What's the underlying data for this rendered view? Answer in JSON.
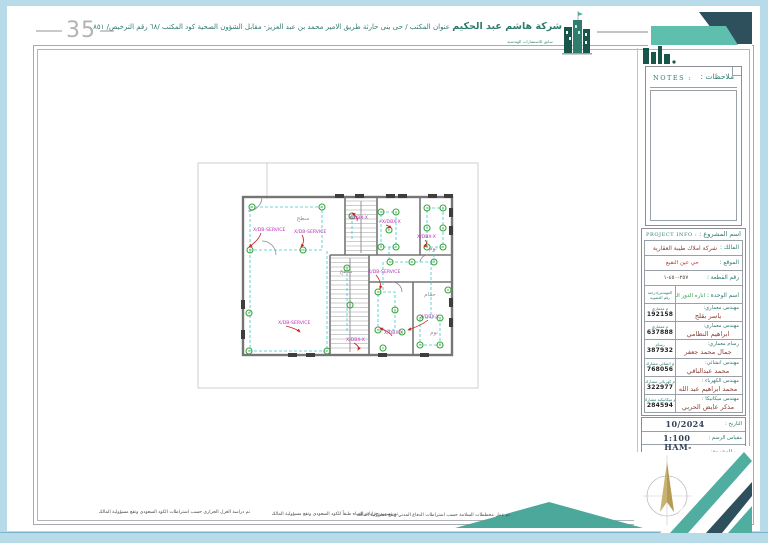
{
  "sheet": {
    "number": "35"
  },
  "header": {
    "company_name": "شركة هاشم عبد الحكيم",
    "company_info": "عنوان المكتب / حى بنى حارثة طريق الامير محمد بن عبد العزيز- مقابل الشؤون الصحية  كود المكتب /٦٨  رقم الترخيص/ ٨٥١",
    "company_sub": "سابق للاستشارات الهندسية"
  },
  "notes": {
    "label_en": "NOTES :",
    "label_ar": "ملاحظات :"
  },
  "project_info": {
    "header_en": "PROJECT INFO :",
    "header_ar": "اسم المشروع :",
    "owner_label": "المالك :",
    "owner_value": "شركة املاك طيبة العقارية",
    "location_label": "الموقع :",
    "location_value": "حي عين النقيع",
    "plot_label": "رقم القطعة :",
    "plot_value": "٢٥٧-٤٥٠-١",
    "unit_label": "اسم الوحدة :",
    "unit_value": "اناره الدور الرابع",
    "col_header_line1": "المهندس/درجته",
    "col_header_line2": "رقم العضوية",
    "engineers": [
      {
        "role": "مهندس معماري:",
        "name": "ياسر بقلج",
        "grade": "م معماري",
        "membership": "192158"
      },
      {
        "role": "مهندس معماري:",
        "name": "ابراهيم النظامي",
        "grade": "م معماري",
        "membership": "637888"
      },
      {
        "role": "رسام معماري:",
        "name": "جمال محمد جعفر",
        "grade": "رسام",
        "membership": "387932"
      },
      {
        "role": "مهندس انشائي:",
        "name": "محمد عبدالباقي",
        "grade": "م انشائي مشارك",
        "membership": "768056"
      },
      {
        "role": "مهندس الكهرباء :",
        "name": "محمد ابراهيم عبد الله",
        "grade": "م كهربائي مشارك",
        "membership": "322977"
      },
      {
        "role": "مهندس ميكانيكا :",
        "name": "مذكر عايض الحربي",
        "grade": "م ميكانيكية مشارك",
        "membership": "284594"
      }
    ]
  },
  "title_block": {
    "date_label": "التاريخ :",
    "date_value": "10/2024",
    "scale_label": "مقياس الرسم :",
    "scale_value": "1:100",
    "project_no_label": "رقم المشروع:",
    "project_no_value": "HAM-0001209"
  },
  "footer": {
    "notes": [
      "تم دراسة العزل الحراري حسب اشتراطات الكود السعودي وتقع مسؤولية المالك",
      "تم تصميم خزانات المياه طبقاً للكود السعودي وتقع مسؤولية المالك",
      "تم عمل مخططات السلامة حسب اشتراطات الدفاع المدني وتقع مسؤولية المالك"
    ]
  },
  "plan": {
    "colors": {
      "wire": "#3cc6ce",
      "fixture": "#3aa53a",
      "label": "#bb33bb",
      "arrow": "#cc2222",
      "wall": "#757575",
      "room_text": "#8f8f8f",
      "boundary": "#bfc3c8"
    },
    "fixtures": [
      [
        252,
        207
      ],
      [
        322,
        207
      ],
      [
        250,
        250
      ],
      [
        303,
        250
      ],
      [
        249,
        313
      ],
      [
        249,
        351
      ],
      [
        327,
        351
      ],
      [
        352,
        216
      ],
      [
        347,
        268
      ],
      [
        350,
        305
      ],
      [
        381,
        212
      ],
      [
        396,
        212
      ],
      [
        381,
        247
      ],
      [
        396,
        247
      ],
      [
        389,
        230
      ],
      [
        427,
        208
      ],
      [
        443,
        208
      ],
      [
        427,
        228
      ],
      [
        443,
        228
      ],
      [
        427,
        247
      ],
      [
        443,
        247
      ],
      [
        412,
        262
      ],
      [
        434,
        262
      ],
      [
        390,
        262
      ],
      [
        378,
        292
      ],
      [
        378,
        330
      ],
      [
        395,
        310
      ],
      [
        383,
        348
      ],
      [
        420,
        318
      ],
      [
        440,
        318
      ],
      [
        420,
        345
      ],
      [
        440,
        345
      ],
      [
        402,
        332
      ],
      [
        448,
        290
      ]
    ],
    "wires": [
      [
        [
          250,
          207
        ],
        [
          322,
          207
        ],
        [
          322,
          250
        ],
        [
          250,
          250
        ],
        [
          250,
          207
        ]
      ],
      [
        [
          250,
          250
        ],
        [
          250,
          351
        ],
        [
          327,
          351
        ],
        [
          327,
          251
        ]
      ],
      [
        [
          381,
          212
        ],
        [
          396,
          212
        ],
        [
          396,
          247
        ],
        [
          381,
          247
        ],
        [
          381,
          212
        ]
      ],
      [
        [
          427,
          208
        ],
        [
          443,
          208
        ],
        [
          443,
          247
        ],
        [
          427,
          247
        ],
        [
          427,
          208
        ]
      ],
      [
        [
          390,
          262
        ],
        [
          434,
          262
        ]
      ],
      [
        [
          389,
          247
        ],
        [
          389,
          262
        ]
      ],
      [
        [
          434,
          249
        ],
        [
          434,
          262
        ]
      ],
      [
        [
          378,
          292
        ],
        [
          395,
          292
        ],
        [
          395,
          330
        ],
        [
          378,
          330
        ],
        [
          378,
          292
        ]
      ],
      [
        [
          420,
          318
        ],
        [
          440,
          318
        ],
        [
          440,
          345
        ],
        [
          420,
          345
        ],
        [
          420,
          318
        ]
      ],
      [
        [
          352,
          216
        ],
        [
          352,
          240
        ]
      ],
      [
        [
          347,
          268
        ],
        [
          347,
          332
        ]
      ],
      [
        [
          383,
          262
        ],
        [
          383,
          292
        ]
      ],
      [
        [
          431,
          262
        ],
        [
          431,
          315
        ]
      ]
    ],
    "labels": [
      {
        "t": "X/DB-SERVICE",
        "x": 253,
        "y": 231,
        "ax": 249,
        "ay": 247
      },
      {
        "t": "X/DB-SERVICE",
        "x": 294,
        "y": 233,
        "ax": 301,
        "ay": 247
      },
      {
        "t": "X/DBX-X",
        "x": 349,
        "y": 219,
        "ax": 352,
        "ay": 213
      },
      {
        "t": "+X/DBX-X",
        "x": 378,
        "y": 223,
        "ax": 388,
        "ay": 228
      },
      {
        "t": "X/DBX-X",
        "x": 417,
        "y": 238,
        "ax": 424,
        "ay": 247
      },
      {
        "t": "X/DB-SERVICE",
        "x": 278,
        "y": 324,
        "ax": 300,
        "ay": 332
      },
      {
        "t": "X/DB-SERVICE",
        "x": 368,
        "y": 273,
        "ax": 380,
        "ay": 289
      },
      {
        "t": "X/DBX-X",
        "x": 346,
        "y": 341,
        "ax": 358,
        "ay": 350
      },
      {
        "t": "X/DBX-X",
        "x": 384,
        "y": 334,
        "ax": 380,
        "ay": 328
      },
      {
        "t": "X/DBX-X",
        "x": 420,
        "y": 318,
        "ax": 408,
        "ay": 330
      }
    ],
    "room_labels": [
      {
        "t": "سطح",
        "x": 303,
        "y": 220
      },
      {
        "t": "سطح",
        "x": 346,
        "y": 273
      },
      {
        "t": "نوم",
        "x": 433,
        "y": 250
      },
      {
        "t": "نوم",
        "x": 434,
        "y": 334
      },
      {
        "t": "حمام",
        "x": 430,
        "y": 296
      }
    ]
  }
}
